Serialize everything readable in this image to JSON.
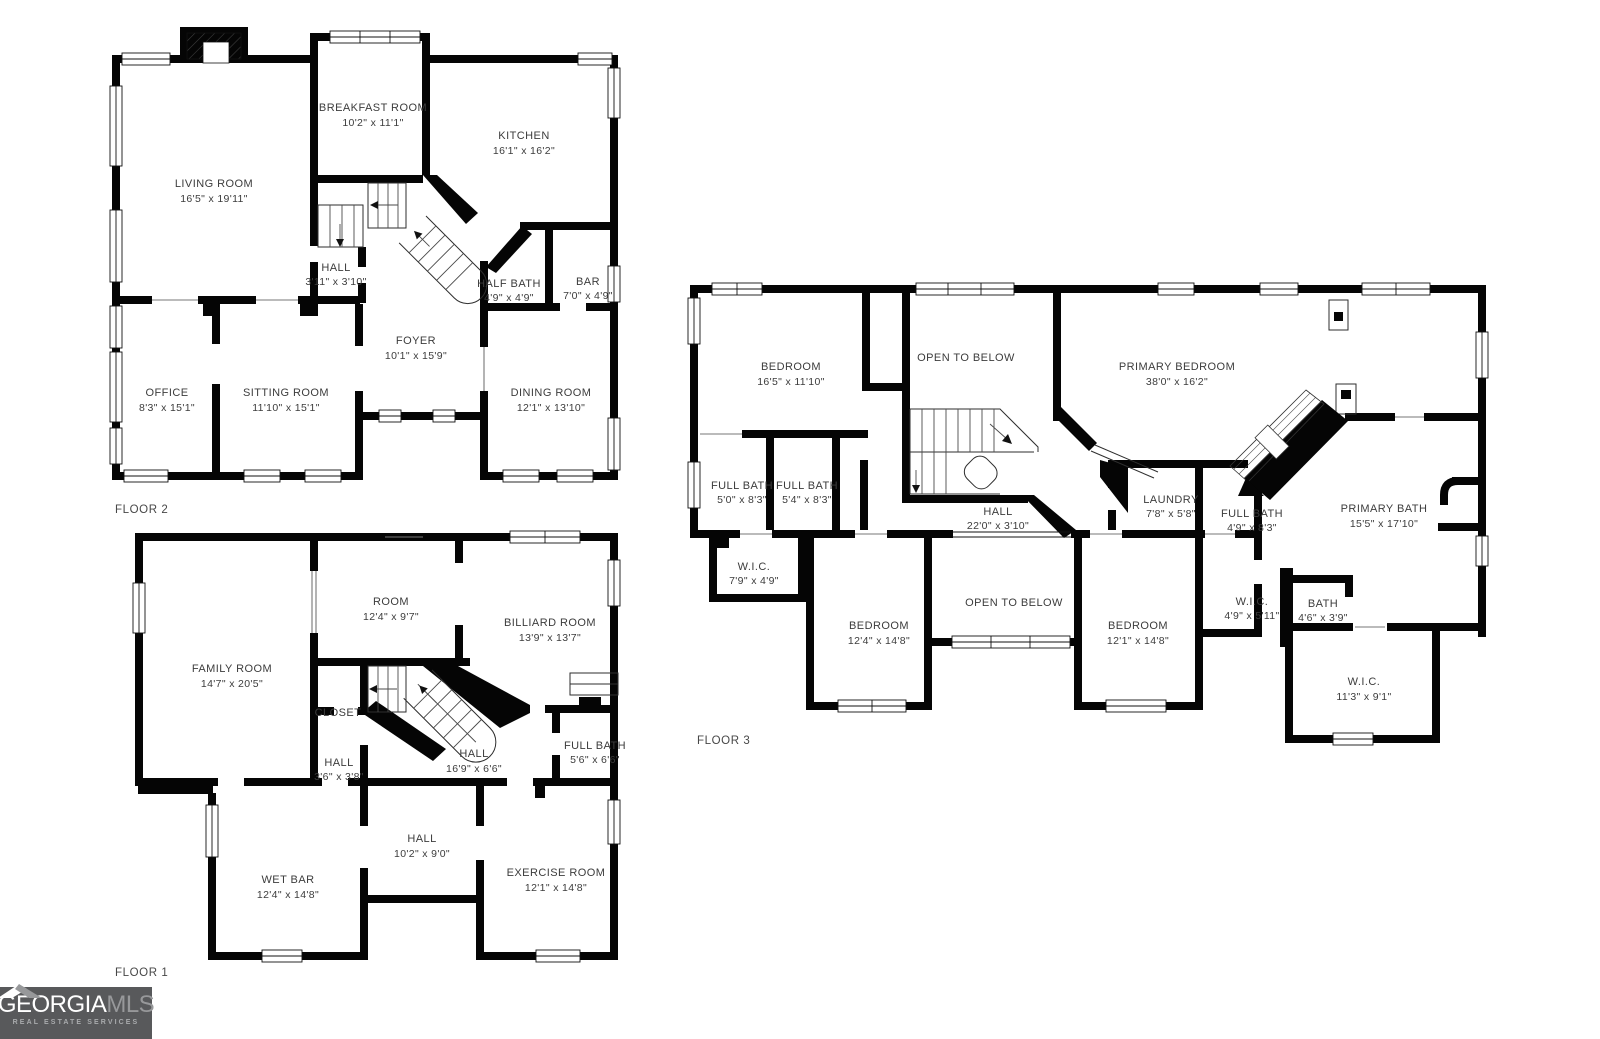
{
  "canvas": {
    "width": 1600,
    "height": 1039,
    "background": "#ffffff"
  },
  "colors": {
    "wall": "#050505",
    "label_text": "#3c3c3c",
    "logo_bg": "#58595b",
    "logo_primary_text": "#ffffff",
    "logo_secondary_text": "#97989a",
    "logo_tagline_text": "#a9abad"
  },
  "branding": {
    "logo_primary": "GEORGIA",
    "logo_secondary": "MLS",
    "logo_tagline": "REAL ESTATE SERVICES",
    "roof_icon": "house-roof"
  },
  "floors": [
    {
      "label": "FLOOR 2",
      "rooms": [
        {
          "name": "LIVING ROOM",
          "dims": "16'5\" x 19'11\""
        },
        {
          "name": "BREAKFAST ROOM",
          "dims": "10'2\" x 11'1\""
        },
        {
          "name": "KITCHEN",
          "dims": "16'1\" x 16'2\""
        },
        {
          "name": "HALL",
          "dims": "3'11\" x 3'10\""
        },
        {
          "name": "HALF BATH",
          "dims": "4'9\" x 4'9\""
        },
        {
          "name": "BAR",
          "dims": "7'0\" x 4'9\""
        },
        {
          "name": "FOYER",
          "dims": "10'1\" x 15'9\""
        },
        {
          "name": "OFFICE",
          "dims": "8'3\" x 15'1\""
        },
        {
          "name": "SITTING ROOM",
          "dims": "11'10\" x 15'1\""
        },
        {
          "name": "DINING ROOM",
          "dims": "12'1\" x 13'10\""
        }
      ]
    },
    {
      "label": "FLOOR 1",
      "rooms": [
        {
          "name": "FAMILY ROOM",
          "dims": "14'7\" x 20'5\""
        },
        {
          "name": "ROOM",
          "dims": "12'4\" x 9'7\""
        },
        {
          "name": "BILLIARD ROOM",
          "dims": "13'9\" x 13'7\""
        },
        {
          "name": "CLOSET",
          "dims": null
        },
        {
          "name": "HALL",
          "dims": "3'6\" x 3'8\""
        },
        {
          "name": "HALL",
          "dims": "16'9\" x 6'6\""
        },
        {
          "name": "FULL BATH",
          "dims": "5'6\" x 6'6\""
        },
        {
          "name": "WET BAR",
          "dims": "12'4\" x 14'8\""
        },
        {
          "name": "HALL",
          "dims": "10'2\" x 9'0\""
        },
        {
          "name": "EXERCISE ROOM",
          "dims": "12'1\" x 14'8\""
        }
      ]
    },
    {
      "label": "FLOOR 3",
      "rooms": [
        {
          "name": "BEDROOM",
          "dims": "16'5\" x 11'10\""
        },
        {
          "name": "OPEN TO BELOW",
          "dims": null
        },
        {
          "name": "PRIMARY BEDROOM",
          "dims": "38'0\" x 16'2\""
        },
        {
          "name": "FULL BATH",
          "dims": "5'0\" x 8'3\""
        },
        {
          "name": "FULL BATH",
          "dims": "5'4\" x 8'3\""
        },
        {
          "name": "HALL",
          "dims": "22'0\" x 3'10\""
        },
        {
          "name": "LAUNDRY",
          "dims": "7'8\" x 5'8\""
        },
        {
          "name": "FULL BATH",
          "dims": "4'9\" x 8'3\""
        },
        {
          "name": "PRIMARY BATH",
          "dims": "15'5\" x 17'10\""
        },
        {
          "name": "W.I.C.",
          "dims": "7'9\" x 4'9\""
        },
        {
          "name": "BEDROOM",
          "dims": "12'4\" x 14'8\""
        },
        {
          "name": "OPEN TO BELOW",
          "dims": null
        },
        {
          "name": "BEDROOM",
          "dims": "12'1\" x 14'8\""
        },
        {
          "name": "W.I.C.",
          "dims": "4'9\" x 5'11\""
        },
        {
          "name": "BATH",
          "dims": "4'6\" x 3'9\""
        },
        {
          "name": "W.I.C.",
          "dims": "11'3\" x 9'1\""
        }
      ]
    }
  ]
}
